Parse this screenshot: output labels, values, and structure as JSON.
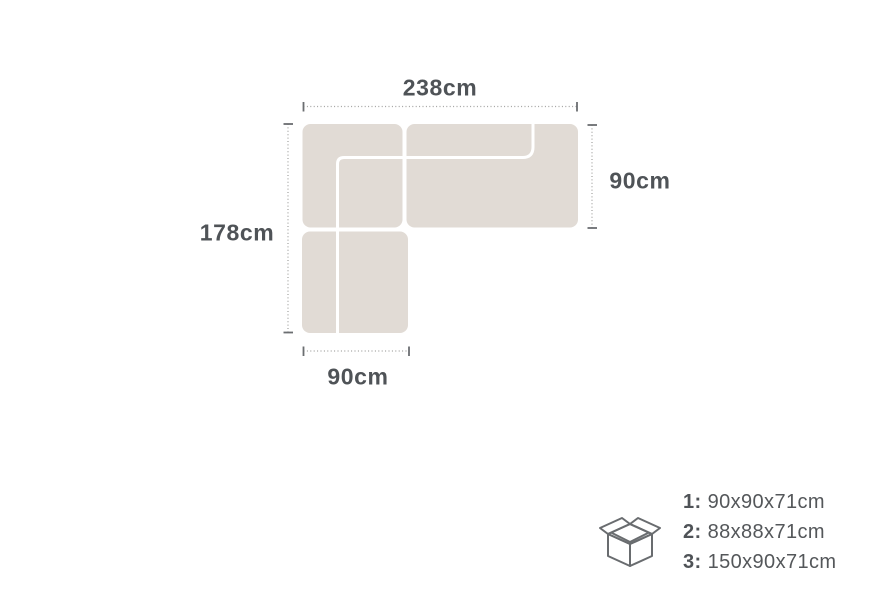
{
  "diagram": {
    "dimensions": {
      "top": "238cm",
      "left": "178cm",
      "right": "90cm",
      "bottom": "90cm"
    },
    "colors": {
      "sofa_fill": "#e1dbd5",
      "seam_line": "#ffffff",
      "dim_line": "#a0a09e",
      "tick": "#6b6e71",
      "label_text": "#4f5357",
      "icon_stroke": "#696c6f"
    }
  },
  "packages": {
    "icon": "open-box-icon",
    "items": [
      {
        "num": "1:",
        "dims": "90x90x71cm"
      },
      {
        "num": "2:",
        "dims": "88x88x71cm"
      },
      {
        "num": "3:",
        "dims": "150x90x71cm"
      }
    ]
  }
}
